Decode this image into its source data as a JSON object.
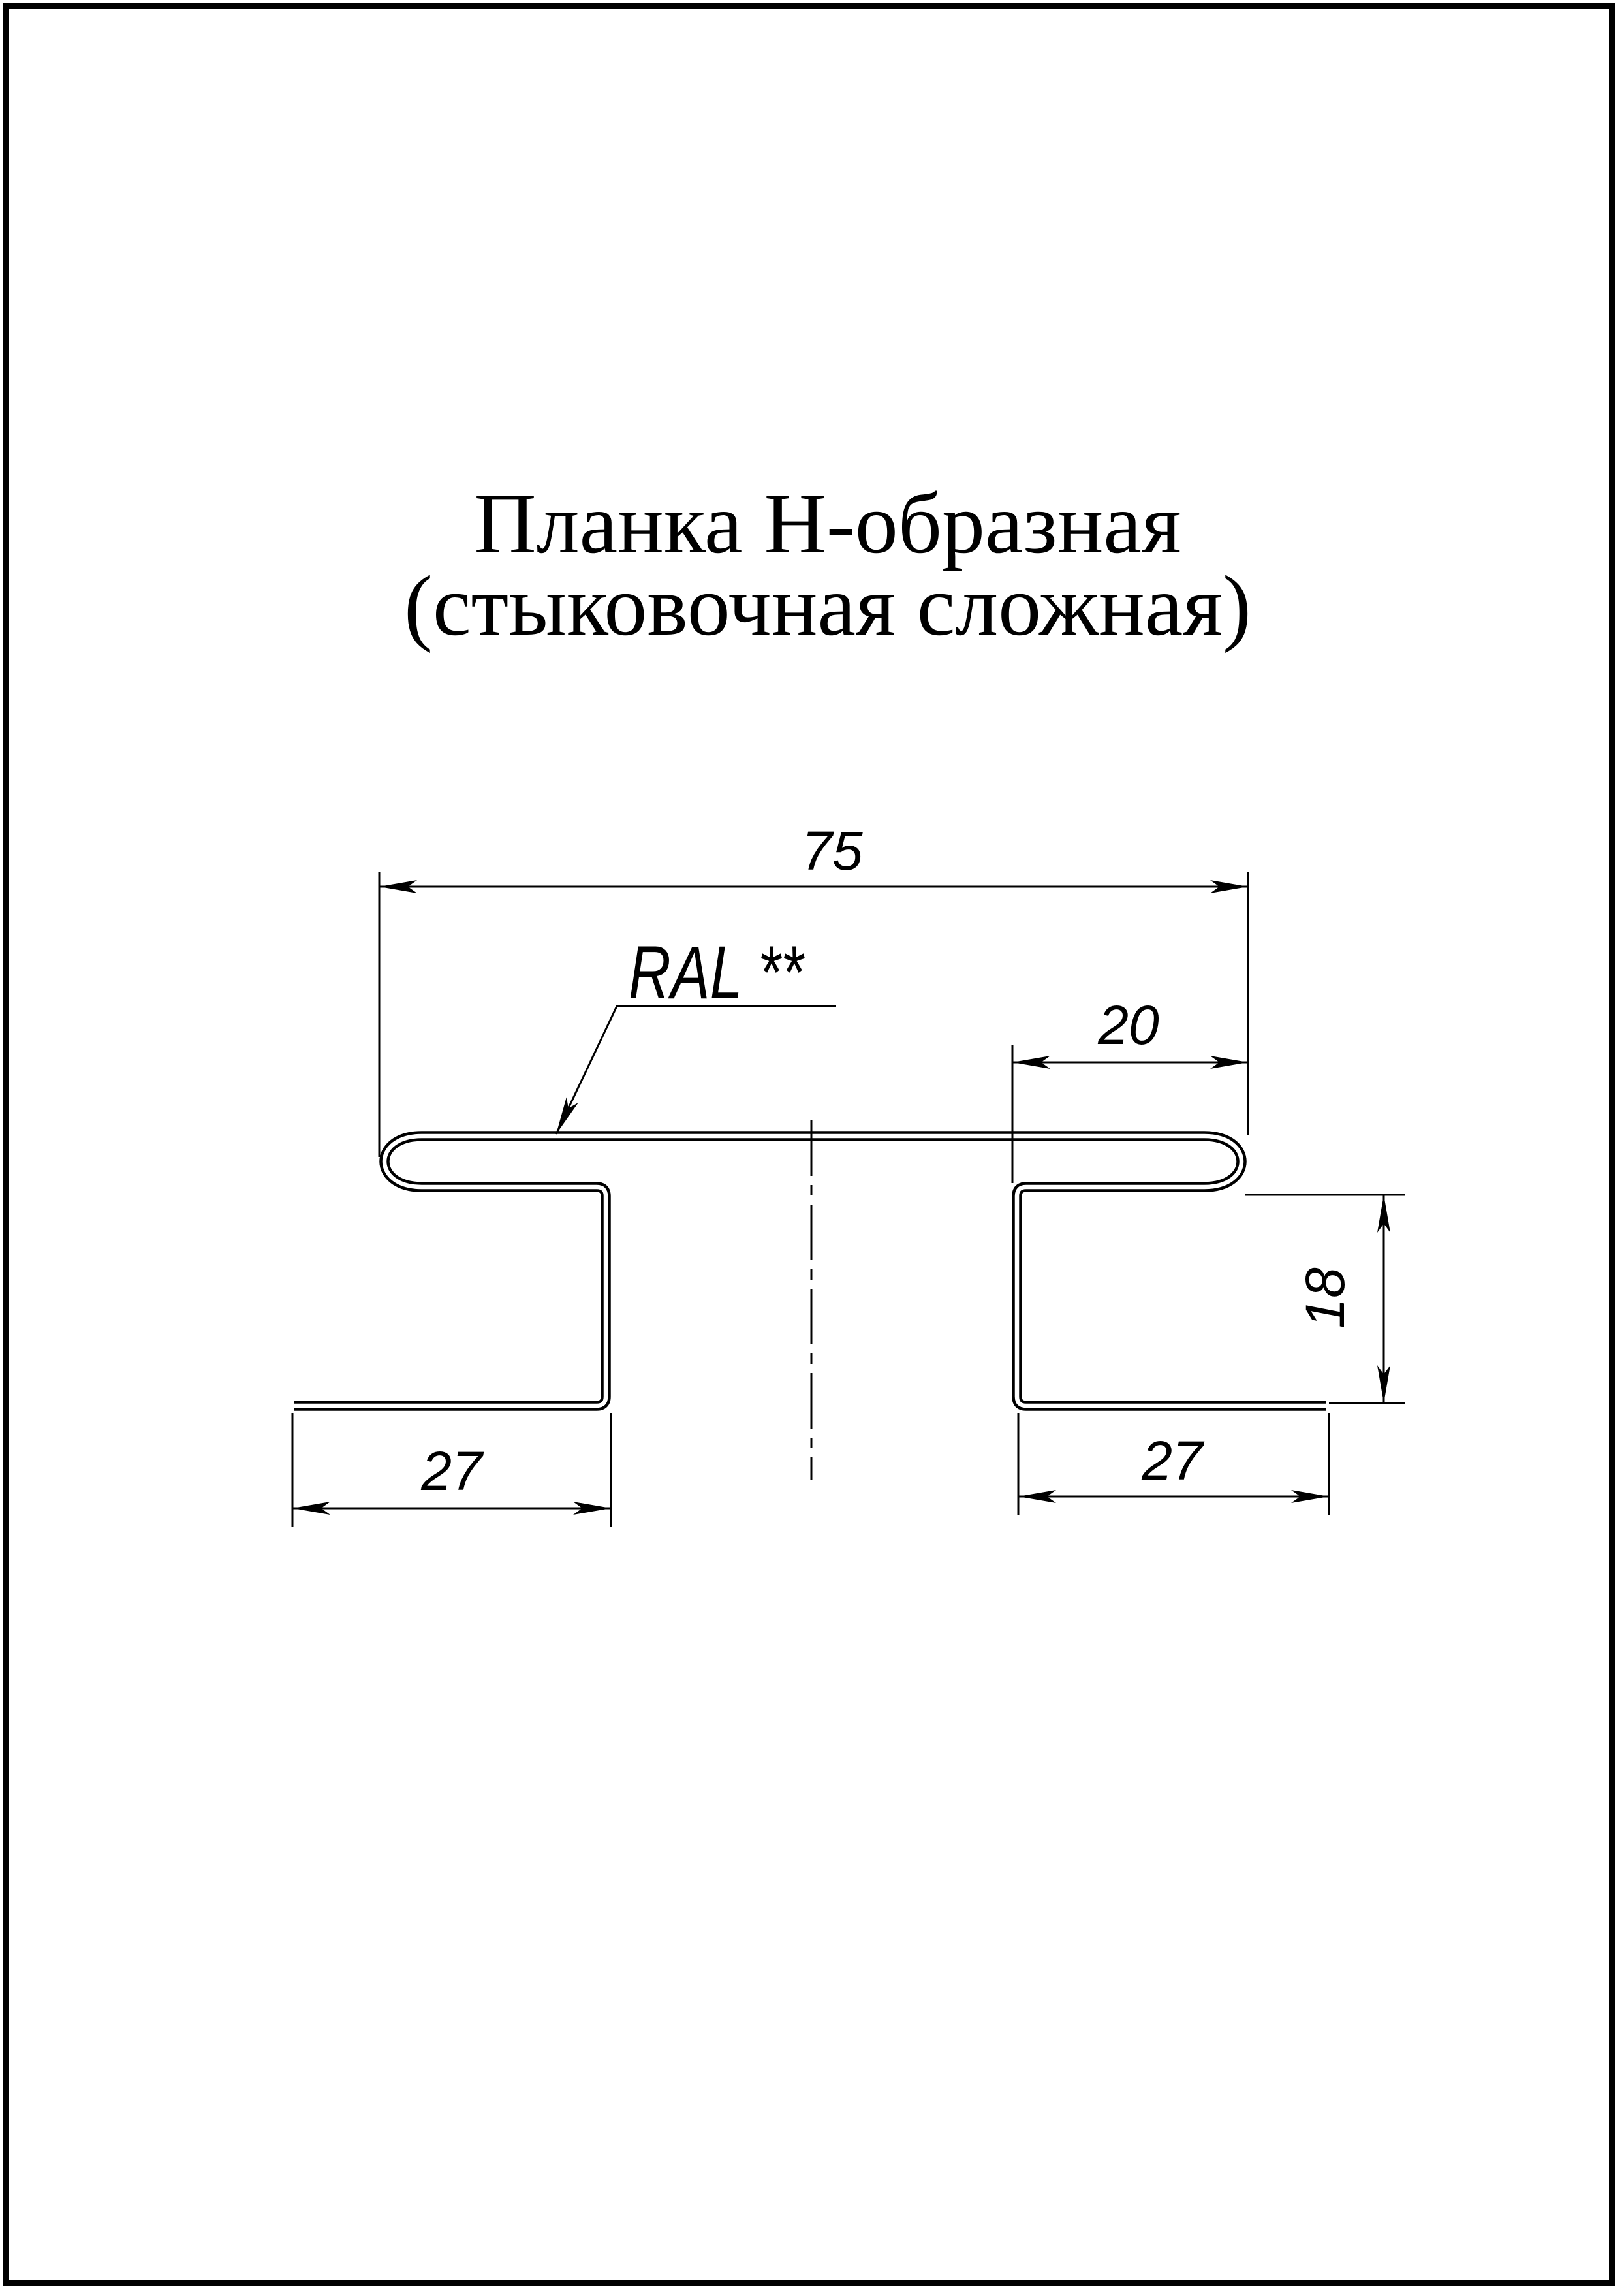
{
  "page": {
    "title_line1": "Планка Н-образная",
    "title_line2": "(стыковочная сложная)",
    "paper_color": "#ffffff",
    "ink_color": "#000000"
  },
  "drawing": {
    "coating_label": "RAL **",
    "dimensions": {
      "overall_width": "75",
      "right_fold_width": "20",
      "leg_height": "18",
      "left_flange": "27",
      "right_flange": "27"
    }
  }
}
